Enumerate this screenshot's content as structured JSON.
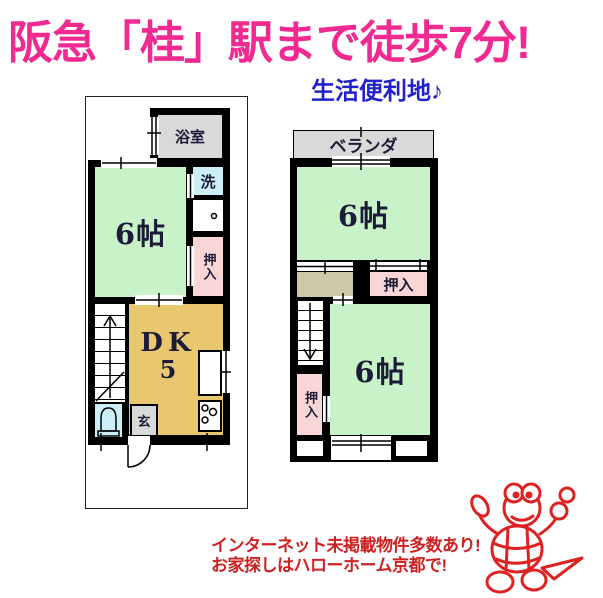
{
  "header": {
    "title": "阪急「桂」駅まで徒歩7分!",
    "subtitle": "生活便利地♪"
  },
  "plan1f": {
    "bath_label": "浴室",
    "laundry_label": "洗",
    "closet_label": "押入",
    "room6_label": "6帖",
    "dk_label": "DK",
    "dk_size": "5",
    "entrance_label": "玄"
  },
  "plan2f": {
    "veranda_label": "ベランダ",
    "room6_top_label": "6帖",
    "closet_top_label": "押入",
    "closet_left_label": "押入",
    "room6_bottom_label": "6帖"
  },
  "footer": {
    "line1": "インターネット未掲載物件多数あり!",
    "line2": "お家探しはハローホーム京都で!"
  },
  "icons": {
    "mascot": "turtle-mascot"
  },
  "colors": {
    "headline_pink": "#f02a90",
    "subheadline_blue": "#2222cc",
    "footer_red": "#cc2222",
    "room_green": "#c8f3c8",
    "dk_orange": "#e9c76f",
    "closet_pink": "#f9d6d6",
    "wet_blue": "#cbeef7",
    "gray_room": "#d9d9d9",
    "landing_tan": "#cfc8a6",
    "label_navy": "#1c1c38",
    "mascot_red": "#dd2222"
  }
}
